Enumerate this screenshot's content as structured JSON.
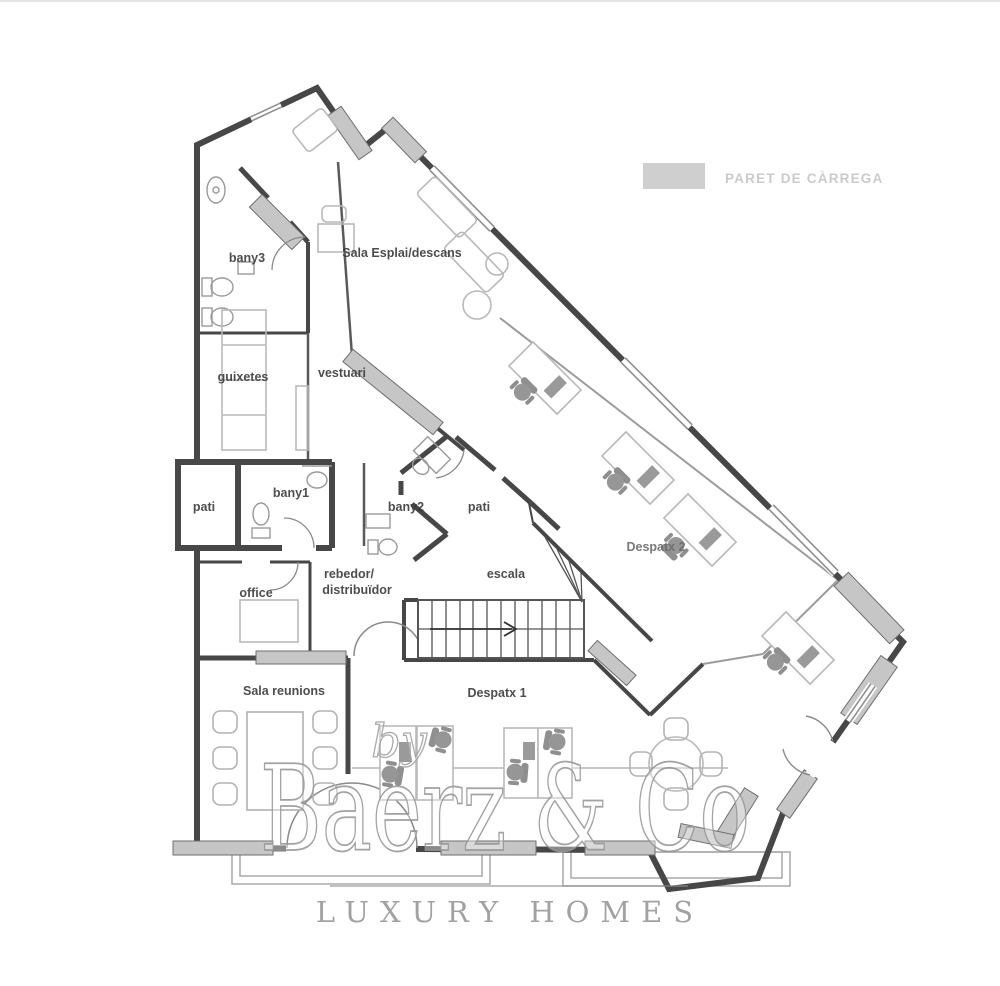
{
  "legend": {
    "label": "PARET DE CÀRREGA",
    "swatch_color": "#cfcfcf"
  },
  "rooms": {
    "bany3": "bany3",
    "sala_esplai": "Sala Esplai/descans",
    "guixetes": "guixetes",
    "vestuari": "vestuari",
    "pati_left": "pati",
    "bany1": "bany1",
    "bany2": "bany2",
    "pati_center": "pati",
    "rebedor_line1": "rebedor/",
    "rebedor_line2": "distribuïdor",
    "escala": "escala",
    "office": "office",
    "sala_reunions": "Sala reunions",
    "despatx1": "Despatx 1",
    "despatx2": "Despatx 2"
  },
  "watermark": {
    "prefix": "by",
    "brand": "Baerz & Co",
    "tagline": "LUXURY HOMES"
  },
  "colors": {
    "wall": "#474747",
    "load_bearing": "#c6c6c6",
    "furniture": "#b9b9b9",
    "label": "#3a3a3a",
    "legend_text": "#cbcbcb",
    "watermark": "#9c9c9c"
  }
}
